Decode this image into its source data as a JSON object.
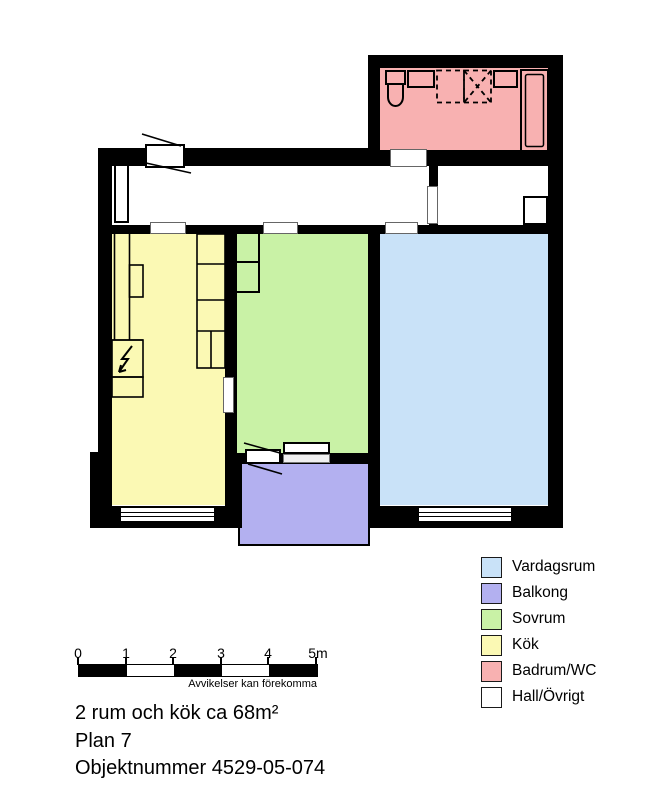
{
  "plan": {
    "wall_color": "#000000",
    "rooms": {
      "vardagsrum": {
        "label": "Vardagsrum",
        "color": "#c9e2f8"
      },
      "balkong": {
        "label": "Balkong",
        "color": "#b3b0f0"
      },
      "sovrum": {
        "label": "Sovrum",
        "color": "#c9f2a6"
      },
      "kok": {
        "label": "Kök",
        "color": "#fbf9b4"
      },
      "badrum": {
        "label": "Badrum/WC",
        "color": "#f8b1b1"
      },
      "hall": {
        "label": "Hall/Övrigt",
        "color": "#ffffff"
      }
    },
    "fixtures": [
      "toilet-icon",
      "sink-icon",
      "shower-dashed-icon",
      "cabinet-icon",
      "bathtub-icon",
      "kitchen-counter",
      "kitchen-sink-icon",
      "stove-lightning-icon",
      "wardrobe",
      "entrance-door",
      "balcony-door",
      "window"
    ]
  },
  "legend": {
    "items": [
      {
        "label": "Vardagsrum",
        "color": "#c9e2f8"
      },
      {
        "label": "Balkong",
        "color": "#b3b0f0"
      },
      {
        "label": "Sovrum",
        "color": "#c9f2a6"
      },
      {
        "label": "Kök",
        "color": "#fbf9b4"
      },
      {
        "label": "Badrum/WC",
        "color": "#f8b1b1"
      },
      {
        "label": "Hall/Övrigt",
        "color": "#ffffff"
      }
    ]
  },
  "scale_bar": {
    "labels": [
      "0",
      "1",
      "2",
      "3",
      "4",
      "5m"
    ],
    "caption": "Avvikelser kan förekomma"
  },
  "footer": {
    "area": "2 rum och kök ca 68m²",
    "plan": "Plan 7",
    "object_number": "Objektnummer 4529-05-074"
  }
}
